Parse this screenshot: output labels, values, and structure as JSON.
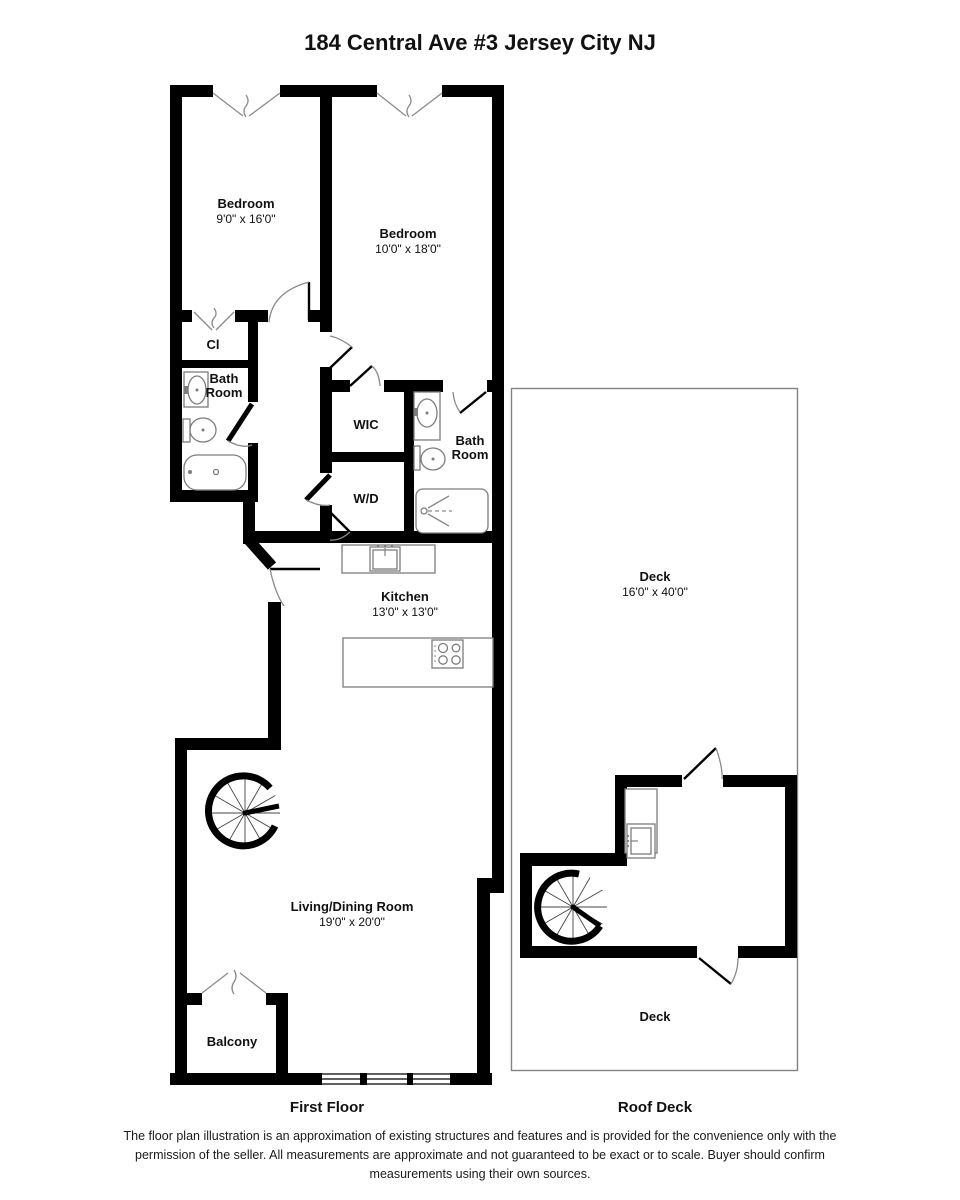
{
  "title": "184 Central Ave #3 Jersey City NJ",
  "first_floor": {
    "floor_label": "First Floor",
    "bedroom1": {
      "name": "Bedroom",
      "dims": "9'0\" x 16'0\""
    },
    "bedroom2": {
      "name": "Bedroom",
      "dims": "10'0\" x 18'0\""
    },
    "closet": {
      "name": "Cl"
    },
    "bath1": {
      "line1": "Bath",
      "line2": "Room"
    },
    "wic": {
      "name": "WIC"
    },
    "wd": {
      "name": "W/D"
    },
    "bath2": {
      "line1": "Bath",
      "line2": "Room"
    },
    "kitchen": {
      "name": "Kitchen",
      "dims": "13'0\" x 13'0\""
    },
    "living": {
      "name": "Living/Dining Room",
      "dims": "19'0\" x 20'0\""
    },
    "balcony": {
      "name": "Balcony"
    }
  },
  "roof_deck": {
    "floor_label": "Roof Deck",
    "deck_upper": {
      "name": "Deck",
      "dims": "16'0\" x 40'0\""
    },
    "deck_lower": {
      "name": "Deck"
    }
  },
  "disclaimer": "The floor plan illustration is an approximation of existing structures and features and is provided for the convenience only with the permission of the seller. All measurements are approximate and not guaranteed to be exact or to scale. Buyer should confirm measurements using their own sources.",
  "colors": {
    "wall": "#000000",
    "fixture_line": "#7d7d7d",
    "deck_outline": "#828282",
    "background": "#ffffff",
    "text": "#1a1a1a"
  }
}
